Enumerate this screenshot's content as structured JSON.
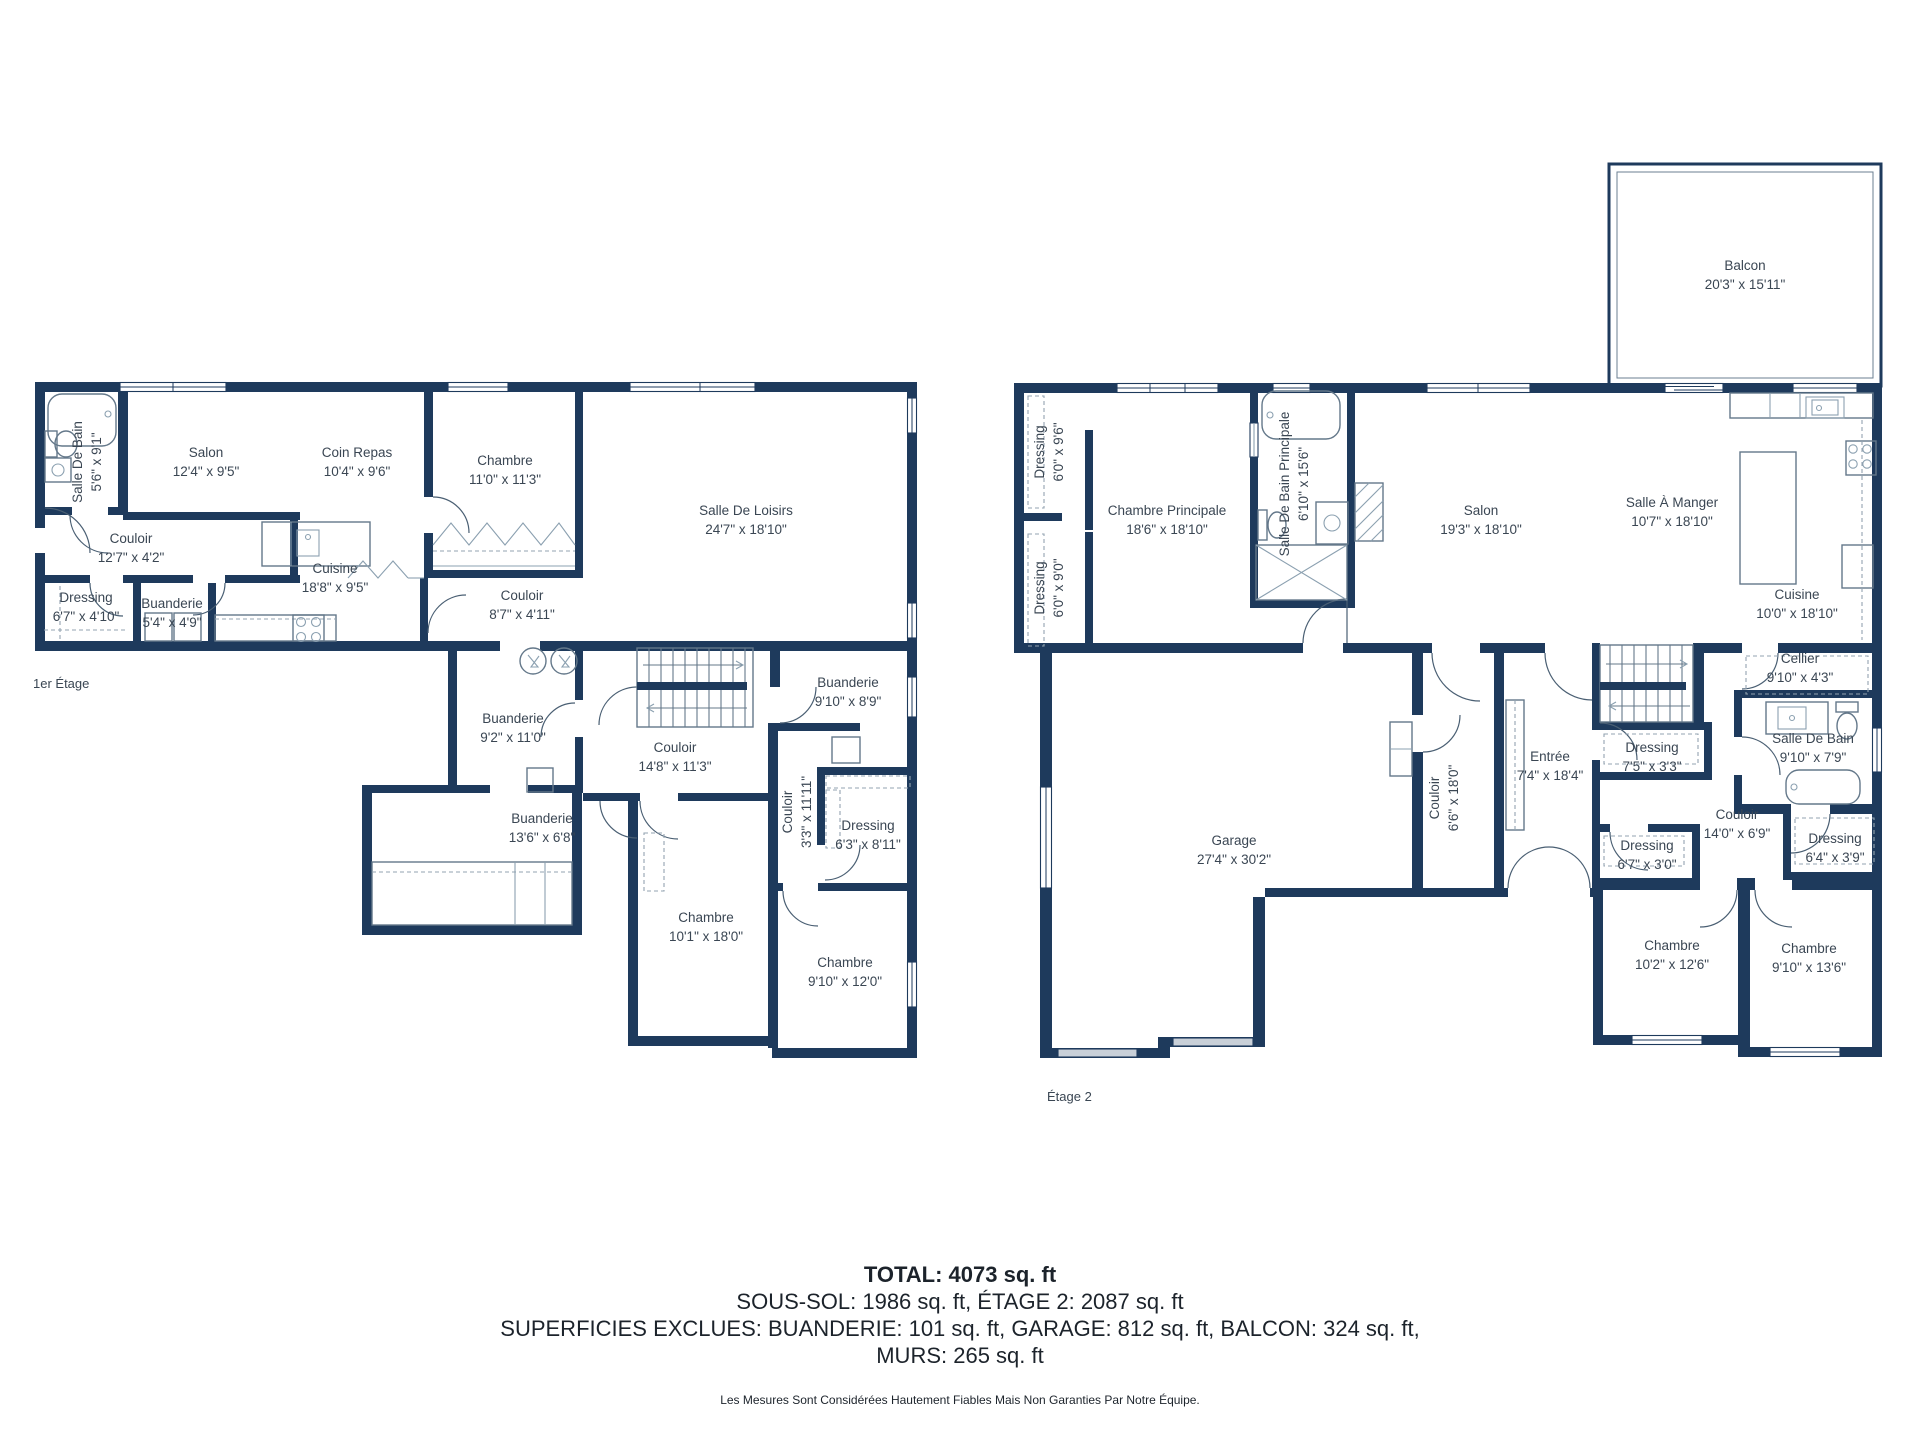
{
  "colors": {
    "wall": "#1e3a5c",
    "label": "#3a4653",
    "window": "#ffffff",
    "door_band": "#c9d0d8"
  },
  "floor1": {
    "title": "1er Étage",
    "rooms": [
      {
        "name": "Salle De Bain",
        "dims": "5'6\" x 9'1\"",
        "x": 87,
        "y": 462,
        "rot": true
      },
      {
        "name": "Salon",
        "dims": "12'4\" x 9'5\"",
        "x": 206,
        "y": 462
      },
      {
        "name": "Coin Repas",
        "dims": "10'4\" x 9'6\"",
        "x": 357,
        "y": 462
      },
      {
        "name": "Chambre",
        "dims": "11'0\" x 11'3\"",
        "x": 505,
        "y": 470
      },
      {
        "name": "Salle De Loisirs",
        "dims": "24'7\" x 18'10\"",
        "x": 746,
        "y": 520
      },
      {
        "name": "Couloir",
        "dims": "12'7\" x 4'2\"",
        "x": 131,
        "y": 548
      },
      {
        "name": "Cuisine",
        "dims": "18'8\" x 9'5\"",
        "x": 335,
        "y": 578
      },
      {
        "name": "Dressing",
        "dims": "6'7\" x 4'10\"",
        "x": 86,
        "y": 607
      },
      {
        "name": "Buanderie",
        "dims": "5'4\" x 4'9\"",
        "x": 172,
        "y": 613
      },
      {
        "name": "Couloir",
        "dims": "8'7\" x 4'11\"",
        "x": 522,
        "y": 605
      },
      {
        "name": "Buanderie",
        "dims": "9'2\" x 11'0\"",
        "x": 513,
        "y": 728
      },
      {
        "name": "Couloir",
        "dims": "14'8\" x 11'3\"",
        "x": 675,
        "y": 757
      },
      {
        "name": "Buanderie",
        "dims": "9'10\" x 8'9\"",
        "x": 848,
        "y": 692
      },
      {
        "name": "Buanderie",
        "dims": "13'6\" x 6'8\"",
        "x": 542,
        "y": 828
      },
      {
        "name": "Couloir",
        "dims": "3'3\" x 11'11\"",
        "x": 797,
        "y": 812,
        "rot": true
      },
      {
        "name": "Dressing",
        "dims": "6'3\" x 8'11\"",
        "x": 868,
        "y": 835
      },
      {
        "name": "Chambre",
        "dims": "10'1\" x 18'0\"",
        "x": 706,
        "y": 927
      },
      {
        "name": "Chambre",
        "dims": "9'10\" x 12'0\"",
        "x": 845,
        "y": 972
      }
    ]
  },
  "floor2": {
    "title": "Étage 2",
    "rooms": [
      {
        "name": "Balcon",
        "dims": "20'3\" x 15'11\"",
        "x": 1745,
        "y": 275
      },
      {
        "name": "Dressing",
        "dims": "6'0\" x 9'6\"",
        "x": 1049,
        "y": 452,
        "rot": true
      },
      {
        "name": "Dressing",
        "dims": "6'0\" x 9'0\"",
        "x": 1049,
        "y": 588,
        "rot": true
      },
      {
        "name": "Chambre Principale",
        "dims": "18'6\" x 18'10\"",
        "x": 1167,
        "y": 520
      },
      {
        "name": "Salle De Bain Principale",
        "dims": "6'10\" x 15'6\"",
        "x": 1294,
        "y": 484,
        "rot": true
      },
      {
        "name": "Salon",
        "dims": "19'3\" x 18'10\"",
        "x": 1481,
        "y": 520
      },
      {
        "name": "Salle À Manger",
        "dims": "10'7\" x 18'10\"",
        "x": 1672,
        "y": 512
      },
      {
        "name": "Cuisine",
        "dims": "10'0\" x 18'10\"",
        "x": 1797,
        "y": 604
      },
      {
        "name": "Cellier",
        "dims": "9'10\" x 4'3\"",
        "x": 1800,
        "y": 668
      },
      {
        "name": "Garage",
        "dims": "27'4\" x 30'2\"",
        "x": 1234,
        "y": 850
      },
      {
        "name": "Couloir",
        "dims": "6'6\" x 18'0\"",
        "x": 1444,
        "y": 798,
        "rot": true
      },
      {
        "name": "Entrée",
        "dims": "7'4\" x 18'4\"",
        "x": 1550,
        "y": 766
      },
      {
        "name": "Dressing",
        "dims": "7'5\" x 3'3\"",
        "x": 1652,
        "y": 757
      },
      {
        "name": "Salle De Bain",
        "dims": "9'10\" x 7'9\"",
        "x": 1813,
        "y": 748
      },
      {
        "name": "Couloir",
        "dims": "14'0\" x 6'9\"",
        "x": 1737,
        "y": 824
      },
      {
        "name": "Dressing",
        "dims": "6'7\" x 3'0\"",
        "x": 1647,
        "y": 855
      },
      {
        "name": "Dressing",
        "dims": "6'4\" x 3'9\"",
        "x": 1835,
        "y": 848
      },
      {
        "name": "Chambre",
        "dims": "10'2\" x 12'6\"",
        "x": 1672,
        "y": 955
      },
      {
        "name": "Chambre",
        "dims": "9'10\" x 13'6\"",
        "x": 1809,
        "y": 958
      }
    ]
  },
  "summary": {
    "total": "TOTAL: 4073 sq. ft",
    "line2": "SOUS-SOL: 1986 sq. ft, ÉTAGE 2: 2087 sq. ft",
    "line3": "SUPERFICIES EXCLUES: BUANDERIE: 101 sq. ft, GARAGE: 812 sq. ft, BALCON: 324 sq. ft,",
    "line4": "MURS: 265 sq. ft",
    "disclaimer": "Les Mesures Sont Considérées Hautement Fiables Mais Non Garanties Par Notre Équipe."
  }
}
